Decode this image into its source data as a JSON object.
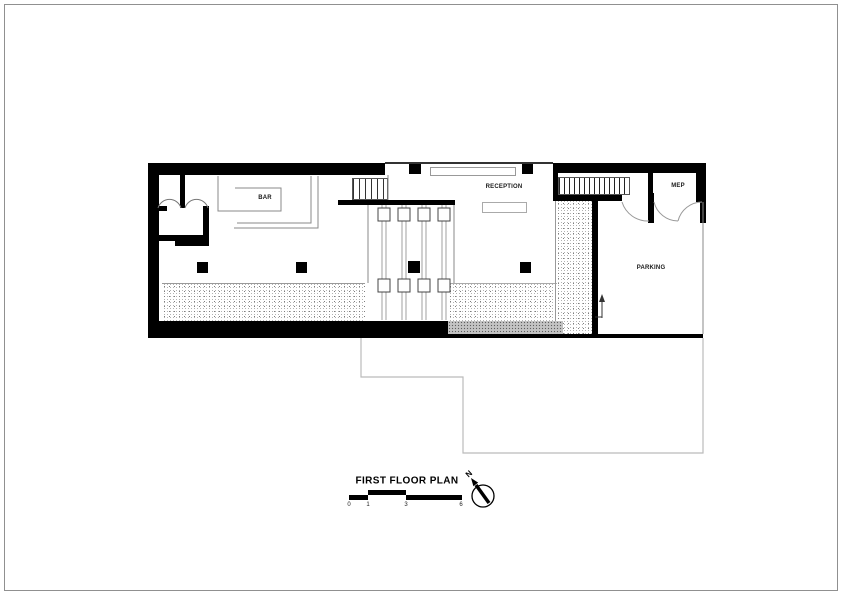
{
  "drawing": {
    "rooms": {
      "bar": "BAR",
      "reception": "RECEPTION",
      "mep": "MEP",
      "parking": "PARKING"
    }
  },
  "title_block": {
    "title": "FIRST FLOOR PLAN",
    "north_label": "N",
    "scale_labels": [
      "0",
      "1",
      "3",
      "6"
    ]
  },
  "colors": {
    "wall": "#000000",
    "thin_line": "#888888",
    "ground_outline": "#bbbbbb",
    "frame": "#909090"
  }
}
